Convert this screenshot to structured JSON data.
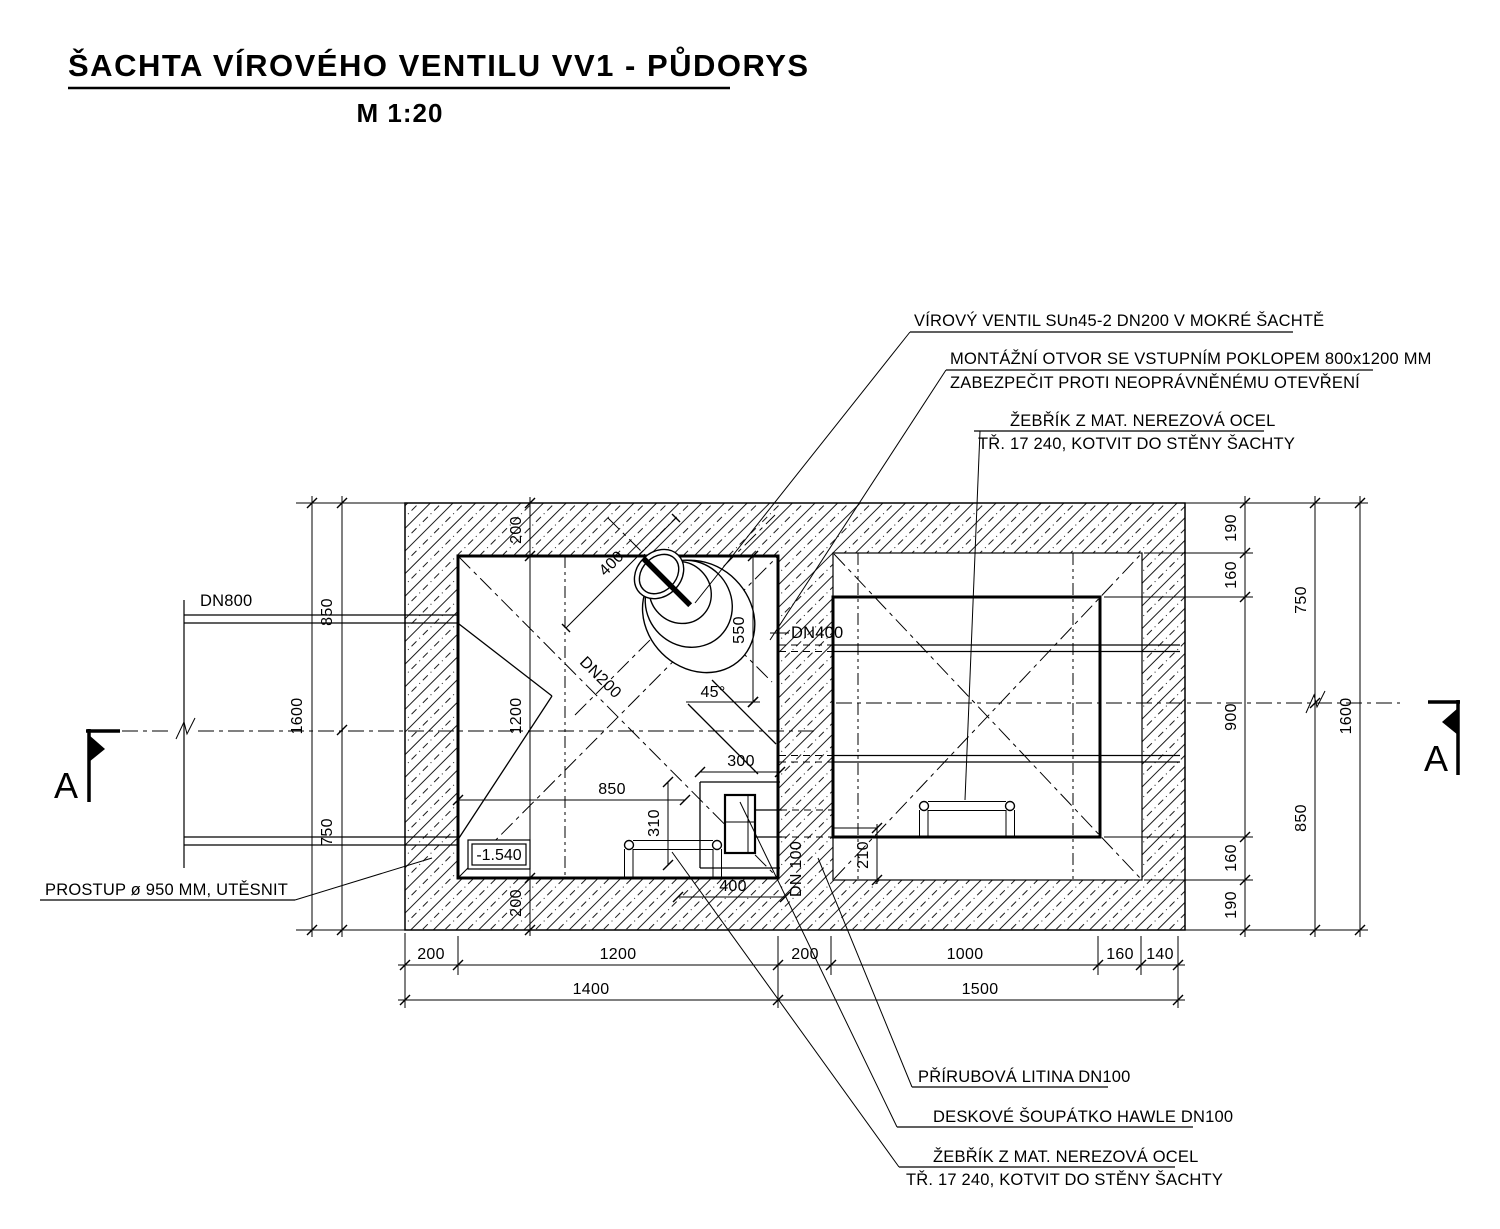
{
  "title": {
    "text": "ŠACHTA VÍROVÉHO VENTILU VV1 - PŮDORYS",
    "scale": "M 1:20"
  },
  "callouts": {
    "vortex_valve": "VÍROVÝ VENTIL SUn45-2 DN200 V MOKRÉ ŠACHTĚ",
    "access_hatch_line1": "MONTÁŽNÍ OTVOR SE VSTUPNÍM POKLOPEM 800x1200 MM",
    "access_hatch_line2": "ZABEZPEČIT PROTI NEOPRÁVNĚNÉMU OTEVŘENÍ",
    "ladder_top_line1": "ŽEBŘÍK Z MAT. NEREZOVÁ OCEL",
    "ladder_top_line2": "TŘ. 17 240, KOTVIT DO STĚNY ŠACHTY",
    "flange_pipe": "PŘÍRUBOVÁ LITINA DN100",
    "gate_valve": "DESKOVÉ ŠOUPÁTKO HAWLE DN100",
    "ladder_bottom_line1": "ŽEBŘÍK Z MAT. NEREZOVÁ OCEL",
    "ladder_bottom_line2": "TŘ. 17 240, KOTVIT DO STĚNY ŠACHTY",
    "wall_opening": "PROSTUP ø 950 MM, UTĚSNIT"
  },
  "pipe_labels": {
    "dn800": "DN800",
    "dn400": "DN400",
    "dn200": "DN200",
    "dn100": "DN 100"
  },
  "level": "-1.540",
  "angle": "45°",
  "section_label": "A",
  "dims": {
    "left_total": "1600",
    "left_top": "850",
    "left_bottom": "750",
    "right_c1": [
      "190",
      "160",
      "900",
      "160",
      "190"
    ],
    "right_d": [
      "750",
      "850"
    ],
    "right_total": "1600",
    "bottom_row1": [
      "200",
      "1200",
      "200",
      "1000",
      "160",
      "140"
    ],
    "bottom_row2": [
      "1400",
      "1500"
    ],
    "inner_left": [
      "200",
      "1200",
      "200"
    ],
    "valve_400": "400",
    "valve_550": "550",
    "niche_300": "300",
    "niche_310": "310",
    "niche_850": "850",
    "niche_400": "400",
    "right_210": "210"
  }
}
